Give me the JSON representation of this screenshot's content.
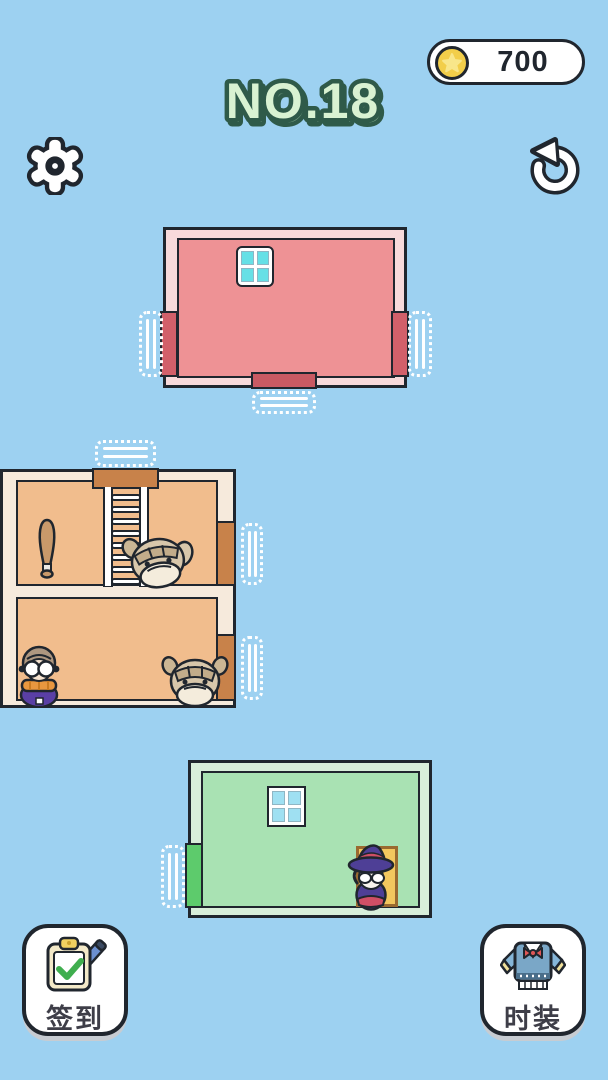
{
  "header": {
    "coin_counter": {
      "value": "700",
      "coin_icon": "gold-coin-star",
      "coin_color": "#f2ce4a"
    },
    "title": {
      "text": "NO.18",
      "fill": "#d9f2d2",
      "stroke": "#2f5a49"
    },
    "settings_icon": "gear",
    "restart_icon": "undo-arrow"
  },
  "scene": {
    "background_color": "#9dd1f1",
    "outline_color": "#20262e",
    "rooms": [
      {
        "name": "pink-room",
        "fill": "#ee9295",
        "frame": "#f8dadb",
        "door_color": "#d2606a",
        "window_color": "#66e0e6",
        "doors": [
          "left",
          "right",
          "bottom"
        ],
        "occupants": []
      },
      {
        "name": "tan-house",
        "fill": "#f1bd8d",
        "frame": "#f6eadc",
        "door_color": "#c8824a",
        "doors": [
          "roof",
          "right-upper",
          "right-lower"
        ],
        "occupants": [
          "baseball-bat",
          "ladder",
          "bulldog-upper",
          "grandma",
          "bulldog-lower"
        ]
      },
      {
        "name": "green-room",
        "fill": "#a9e2b3",
        "frame": "#d8eeda",
        "door_color": "#5dcb6c",
        "window_color": "#9fe0f2",
        "doors": [
          "left"
        ],
        "occupants": [
          "witch",
          "yellow-closet-door"
        ]
      }
    ]
  },
  "footer": {
    "checkin": {
      "label": "签到",
      "icon": "clipboard-check-pen"
    },
    "fashion": {
      "label": "时装",
      "icon": "sweater-bowtie"
    }
  }
}
